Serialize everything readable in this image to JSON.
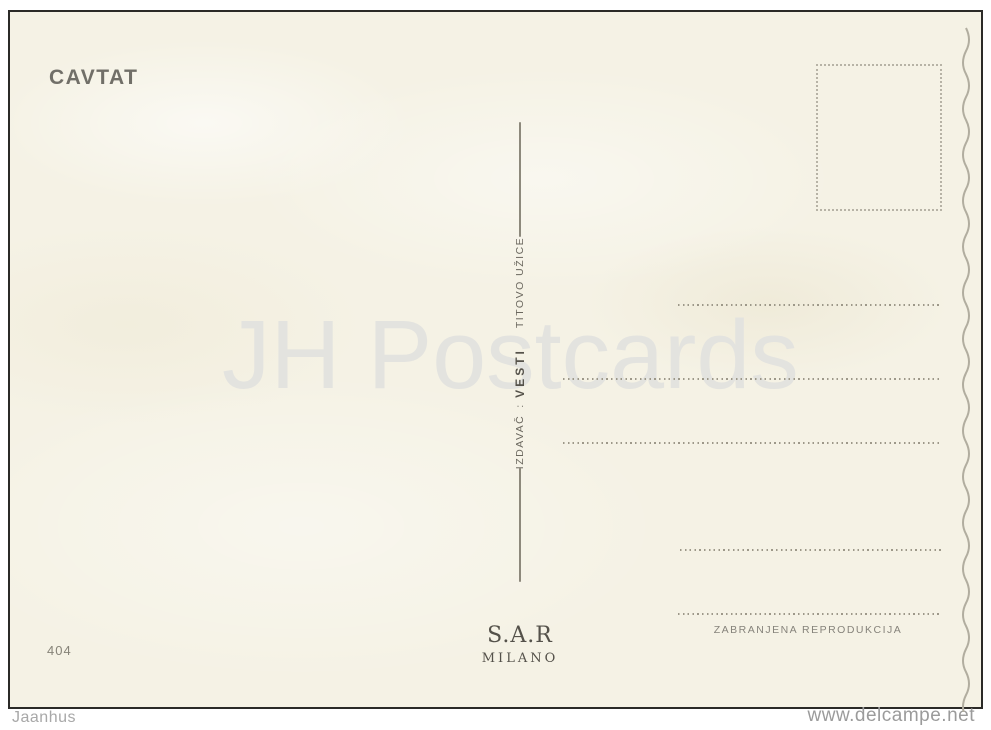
{
  "postcard": {
    "title": "CAVTAT",
    "card_number": "404",
    "publisher_line": {
      "label": "IZDAVAČ",
      "separator": ":",
      "name": "VESTI",
      "city": "TITOVO UŽICE"
    },
    "printer": {
      "name": "S.A.R",
      "city": "MILANO"
    },
    "reproduction_notice": "ZABRANJENA REPRODUKCIJA",
    "colors": {
      "paper": "#f5f2e5",
      "title_ink": "#716f68",
      "dotted_line": "#9d9889",
      "border": "#2b2a27"
    }
  },
  "overlay": {
    "watermark": "JH Postcards",
    "footer_left": "Jaanhus",
    "footer_right": "www.delcampe.net"
  }
}
